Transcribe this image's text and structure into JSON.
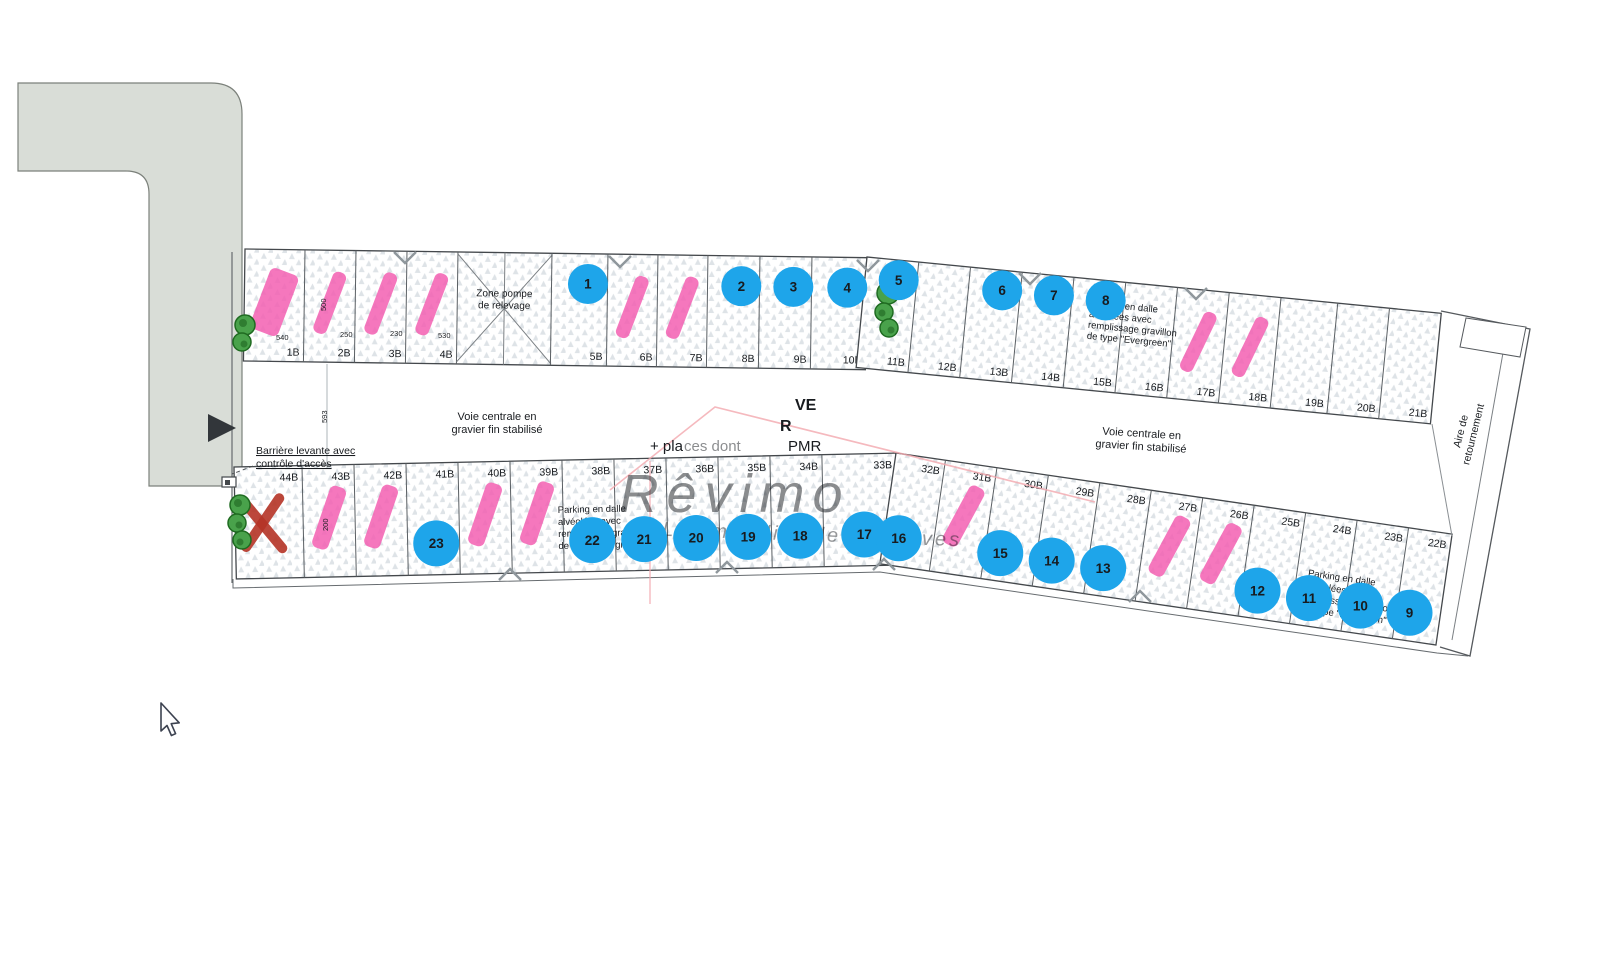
{
  "annotations": {
    "zone_pompe": [
      "Zone pompe",
      "de relevage"
    ],
    "voie_centrale": [
      "Voie centrale en",
      "gravier fin stabilisé"
    ],
    "barriere": [
      "Barrière levante avec",
      "contrôle d'accès"
    ],
    "parking_dalle": [
      "Parking en dalle",
      "alvéolées avec",
      "remplissage gravillon",
      "de type \"Evergreen\""
    ],
    "aire_retournement": [
      "Aire de",
      "retournement"
    ],
    "obscured": {
      "ve": "VE",
      "r": "R",
      "places_prefix": "+ pla",
      "places_mid": "ces dont",
      "pmr": "PMR"
    }
  },
  "watermark": {
    "brand": "Rêvimo",
    "tagline": "L'immobilier de vos rêves"
  },
  "dimensions": [
    "540",
    "250",
    "230",
    "530",
    "500",
    "593",
    "200"
  ],
  "lots": {
    "top": [
      {
        "id": "1B",
        "status": "reserved"
      },
      {
        "id": "2B",
        "status": "reserved"
      },
      {
        "id": "3B",
        "status": "reserved"
      },
      {
        "id": "4B",
        "status": "reserved"
      },
      {
        "id": "",
        "status": "pump"
      },
      {
        "id": "5B",
        "status": "available",
        "circle": 1
      },
      {
        "id": "6B",
        "status": "reserved"
      },
      {
        "id": "7B",
        "status": "reserved"
      },
      {
        "id": "8B",
        "status": "available",
        "circle": 2
      },
      {
        "id": "9B",
        "status": "available",
        "circle": 3
      },
      {
        "id": "10B",
        "status": "available",
        "circle": 4
      },
      {
        "id": "11B",
        "status": "available",
        "circle": 5
      },
      {
        "id": "12B",
        "status": "none"
      },
      {
        "id": "13B",
        "status": "available",
        "circle": 6
      },
      {
        "id": "14B",
        "status": "available",
        "circle": 7
      },
      {
        "id": "15B",
        "status": "available",
        "circle": 8
      },
      {
        "id": "16B",
        "status": "none"
      },
      {
        "id": "17B",
        "status": "reserved"
      },
      {
        "id": "18B",
        "status": "reserved"
      },
      {
        "id": "19B",
        "status": "none"
      },
      {
        "id": "20B",
        "status": "none"
      },
      {
        "id": "21B",
        "status": "none"
      }
    ],
    "bottom": [
      {
        "id": "44B",
        "status": "sold"
      },
      {
        "id": "43B",
        "status": "reserved"
      },
      {
        "id": "42B",
        "status": "reserved"
      },
      {
        "id": "41B",
        "status": "available",
        "circle": 23
      },
      {
        "id": "40B",
        "status": "reserved"
      },
      {
        "id": "39B",
        "status": "reserved"
      },
      {
        "id": "38B",
        "status": "available",
        "circle": 22
      },
      {
        "id": "37B",
        "status": "available",
        "circle": 21
      },
      {
        "id": "36B",
        "status": "available",
        "circle": 20
      },
      {
        "id": "35B",
        "status": "available",
        "circle": 19
      },
      {
        "id": "34B",
        "status": "available",
        "circle": 18
      },
      {
        "id": "33B",
        "status": "available",
        "circle": 17
      },
      {
        "id": "32B",
        "status": "available",
        "circle": 16
      },
      {
        "id": "31B",
        "status": "reserved"
      },
      {
        "id": "30B",
        "status": "available",
        "circle": 15
      },
      {
        "id": "29B",
        "status": "available",
        "circle": 14
      },
      {
        "id": "28B",
        "status": "available",
        "circle": 13
      },
      {
        "id": "27B",
        "status": "reserved"
      },
      {
        "id": "26B",
        "status": "reserved"
      },
      {
        "id": "25B",
        "status": "available",
        "circle": 12
      },
      {
        "id": "24B",
        "status": "available",
        "circle": 11
      },
      {
        "id": "23B",
        "status": "available",
        "circle": 10
      },
      {
        "id": "22B",
        "status": "available",
        "circle": 9
      }
    ]
  },
  "colors": {
    "marker_blue": "#1ea5ea",
    "reserved_pink": "#f35fb2",
    "sold_red": "#b53426",
    "road_gray": "#d9ddd7",
    "pattern_gray": "#c3ccd3",
    "watermark_green": "#8cc998",
    "roof_pink": "#f3a8ae"
  }
}
